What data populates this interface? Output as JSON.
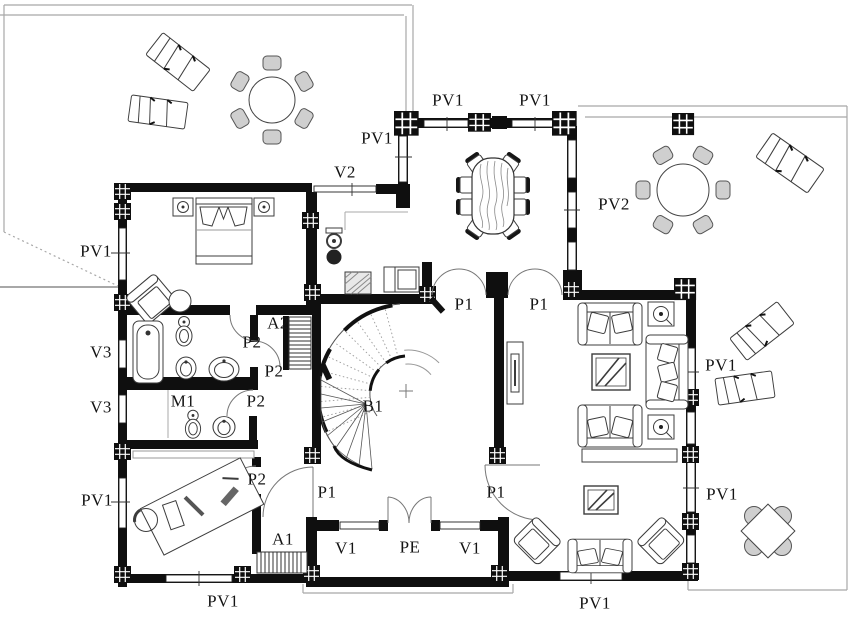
{
  "drawing": {
    "kind": "residential floor plan",
    "colors": {
      "wall": "#0f0f0f",
      "line": "#3c3c3c",
      "terrace_line": "#a8a8a8",
      "chair_fill": "#cfcfcf",
      "paper": "#ffffff"
    }
  },
  "labels": [
    {
      "id": "pv1-top-left",
      "text": "PV1",
      "x": 377,
      "y": 138
    },
    {
      "id": "pv1-top-a",
      "text": "PV1",
      "x": 448,
      "y": 100
    },
    {
      "id": "pv1-top-b",
      "text": "PV1",
      "x": 535,
      "y": 100
    },
    {
      "id": "v2",
      "text": "V2",
      "x": 345,
      "y": 172
    },
    {
      "id": "pv2",
      "text": "PV2",
      "x": 614,
      "y": 204
    },
    {
      "id": "pv1-left-upper",
      "text": "PV1",
      "x": 96,
      "y": 251
    },
    {
      "id": "v3-upper",
      "text": "V3",
      "x": 101,
      "y": 352
    },
    {
      "id": "v3-lower",
      "text": "V3",
      "x": 101,
      "y": 407
    },
    {
      "id": "pv1-left-lower",
      "text": "PV1",
      "x": 97,
      "y": 500
    },
    {
      "id": "pv1-bottom-left",
      "text": "PV1",
      "x": 223,
      "y": 601
    },
    {
      "id": "pv1-bottom-center",
      "text": "PV1",
      "x": 595,
      "y": 603
    },
    {
      "id": "pv1-right-upper",
      "text": "PV1",
      "x": 721,
      "y": 365
    },
    {
      "id": "pv1-right-lower",
      "text": "PV1",
      "x": 722,
      "y": 494
    },
    {
      "id": "p1-dining-left",
      "text": "P1",
      "x": 464,
      "y": 304
    },
    {
      "id": "p1-dining-right",
      "text": "P1",
      "x": 539,
      "y": 304
    },
    {
      "id": "p1-hall-left",
      "text": "P1",
      "x": 327,
      "y": 492
    },
    {
      "id": "p1-hall-right",
      "text": "P1",
      "x": 496,
      "y": 492
    },
    {
      "id": "p2-bath",
      "text": "P2",
      "x": 252,
      "y": 342
    },
    {
      "id": "p2-corridor",
      "text": "P2",
      "x": 274,
      "y": 371
    },
    {
      "id": "p2-m1",
      "text": "P2",
      "x": 256,
      "y": 401
    },
    {
      "id": "p2-study",
      "text": "P2",
      "x": 257,
      "y": 479
    },
    {
      "id": "m1",
      "text": "M1",
      "x": 183,
      "y": 401
    },
    {
      "id": "a2",
      "text": "A2",
      "x": 278,
      "y": 323
    },
    {
      "id": "a1",
      "text": "A1",
      "x": 283,
      "y": 539
    },
    {
      "id": "b1",
      "text": "B1",
      "x": 373,
      "y": 406
    },
    {
      "id": "pe",
      "text": "PE",
      "x": 410,
      "y": 547
    },
    {
      "id": "v1-left",
      "text": "V1",
      "x": 346,
      "y": 548
    },
    {
      "id": "v1-right",
      "text": "V1",
      "x": 470,
      "y": 548
    }
  ]
}
